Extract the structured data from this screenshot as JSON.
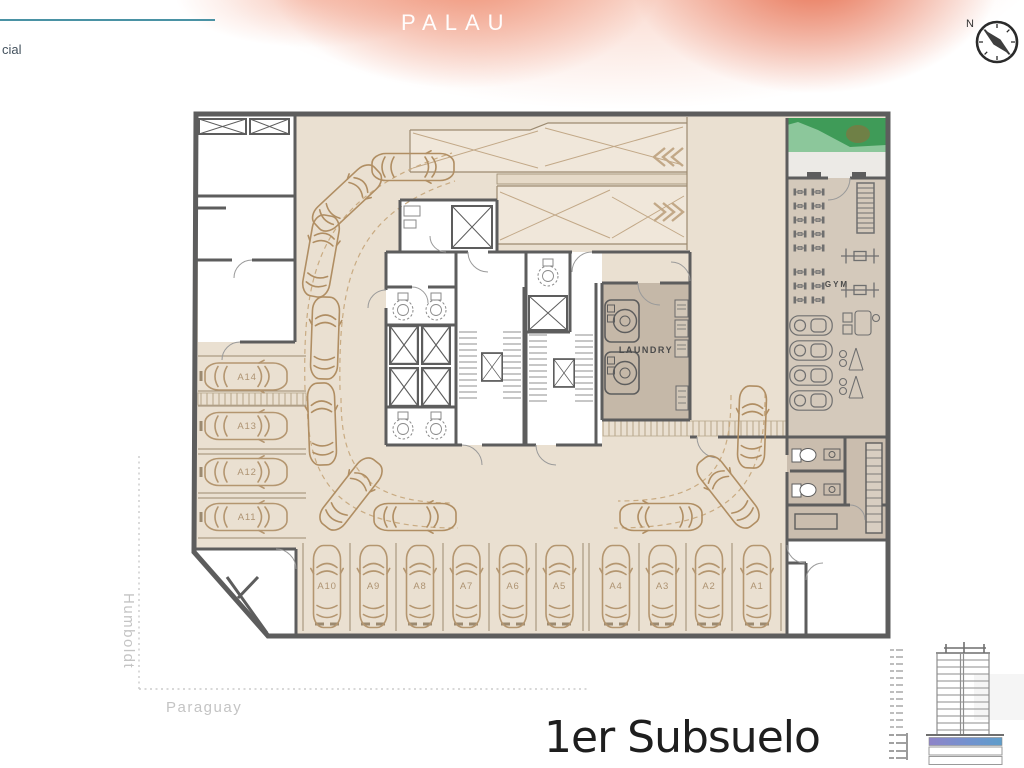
{
  "header": {
    "brand": "PALAU",
    "partner_text_partial": "cial"
  },
  "compass": {
    "north_label": "N"
  },
  "floor_plan": {
    "room_labels": {
      "laundry": "LAUNDRY",
      "gym": "GYM"
    },
    "parking_left_column": [
      "A14",
      "A13",
      "A12",
      "A11"
    ],
    "parking_bottom_row": [
      "A10",
      "A9",
      "A8",
      "A7",
      "A6",
      "A5",
      "A4",
      "A3",
      "A2",
      "A1"
    ],
    "street_labels": {
      "west": "Humboldt",
      "south": "Paraguay"
    }
  },
  "footer": {
    "floor_title": "1er Subsuelo"
  },
  "colors": {
    "accent_salmon": "#ed9478",
    "teal_rule": "#4a92a4",
    "floor_beige": "#eae0d1",
    "service_tan": "#c5b8a8",
    "wall_gray": "#5d5d5d",
    "car_outline": "#b49670",
    "green_light": "#8cc79b",
    "green_dark": "#3f9b58",
    "elevation_purple": "#8f84c8",
    "elevation_blue": "#5e9dca"
  }
}
